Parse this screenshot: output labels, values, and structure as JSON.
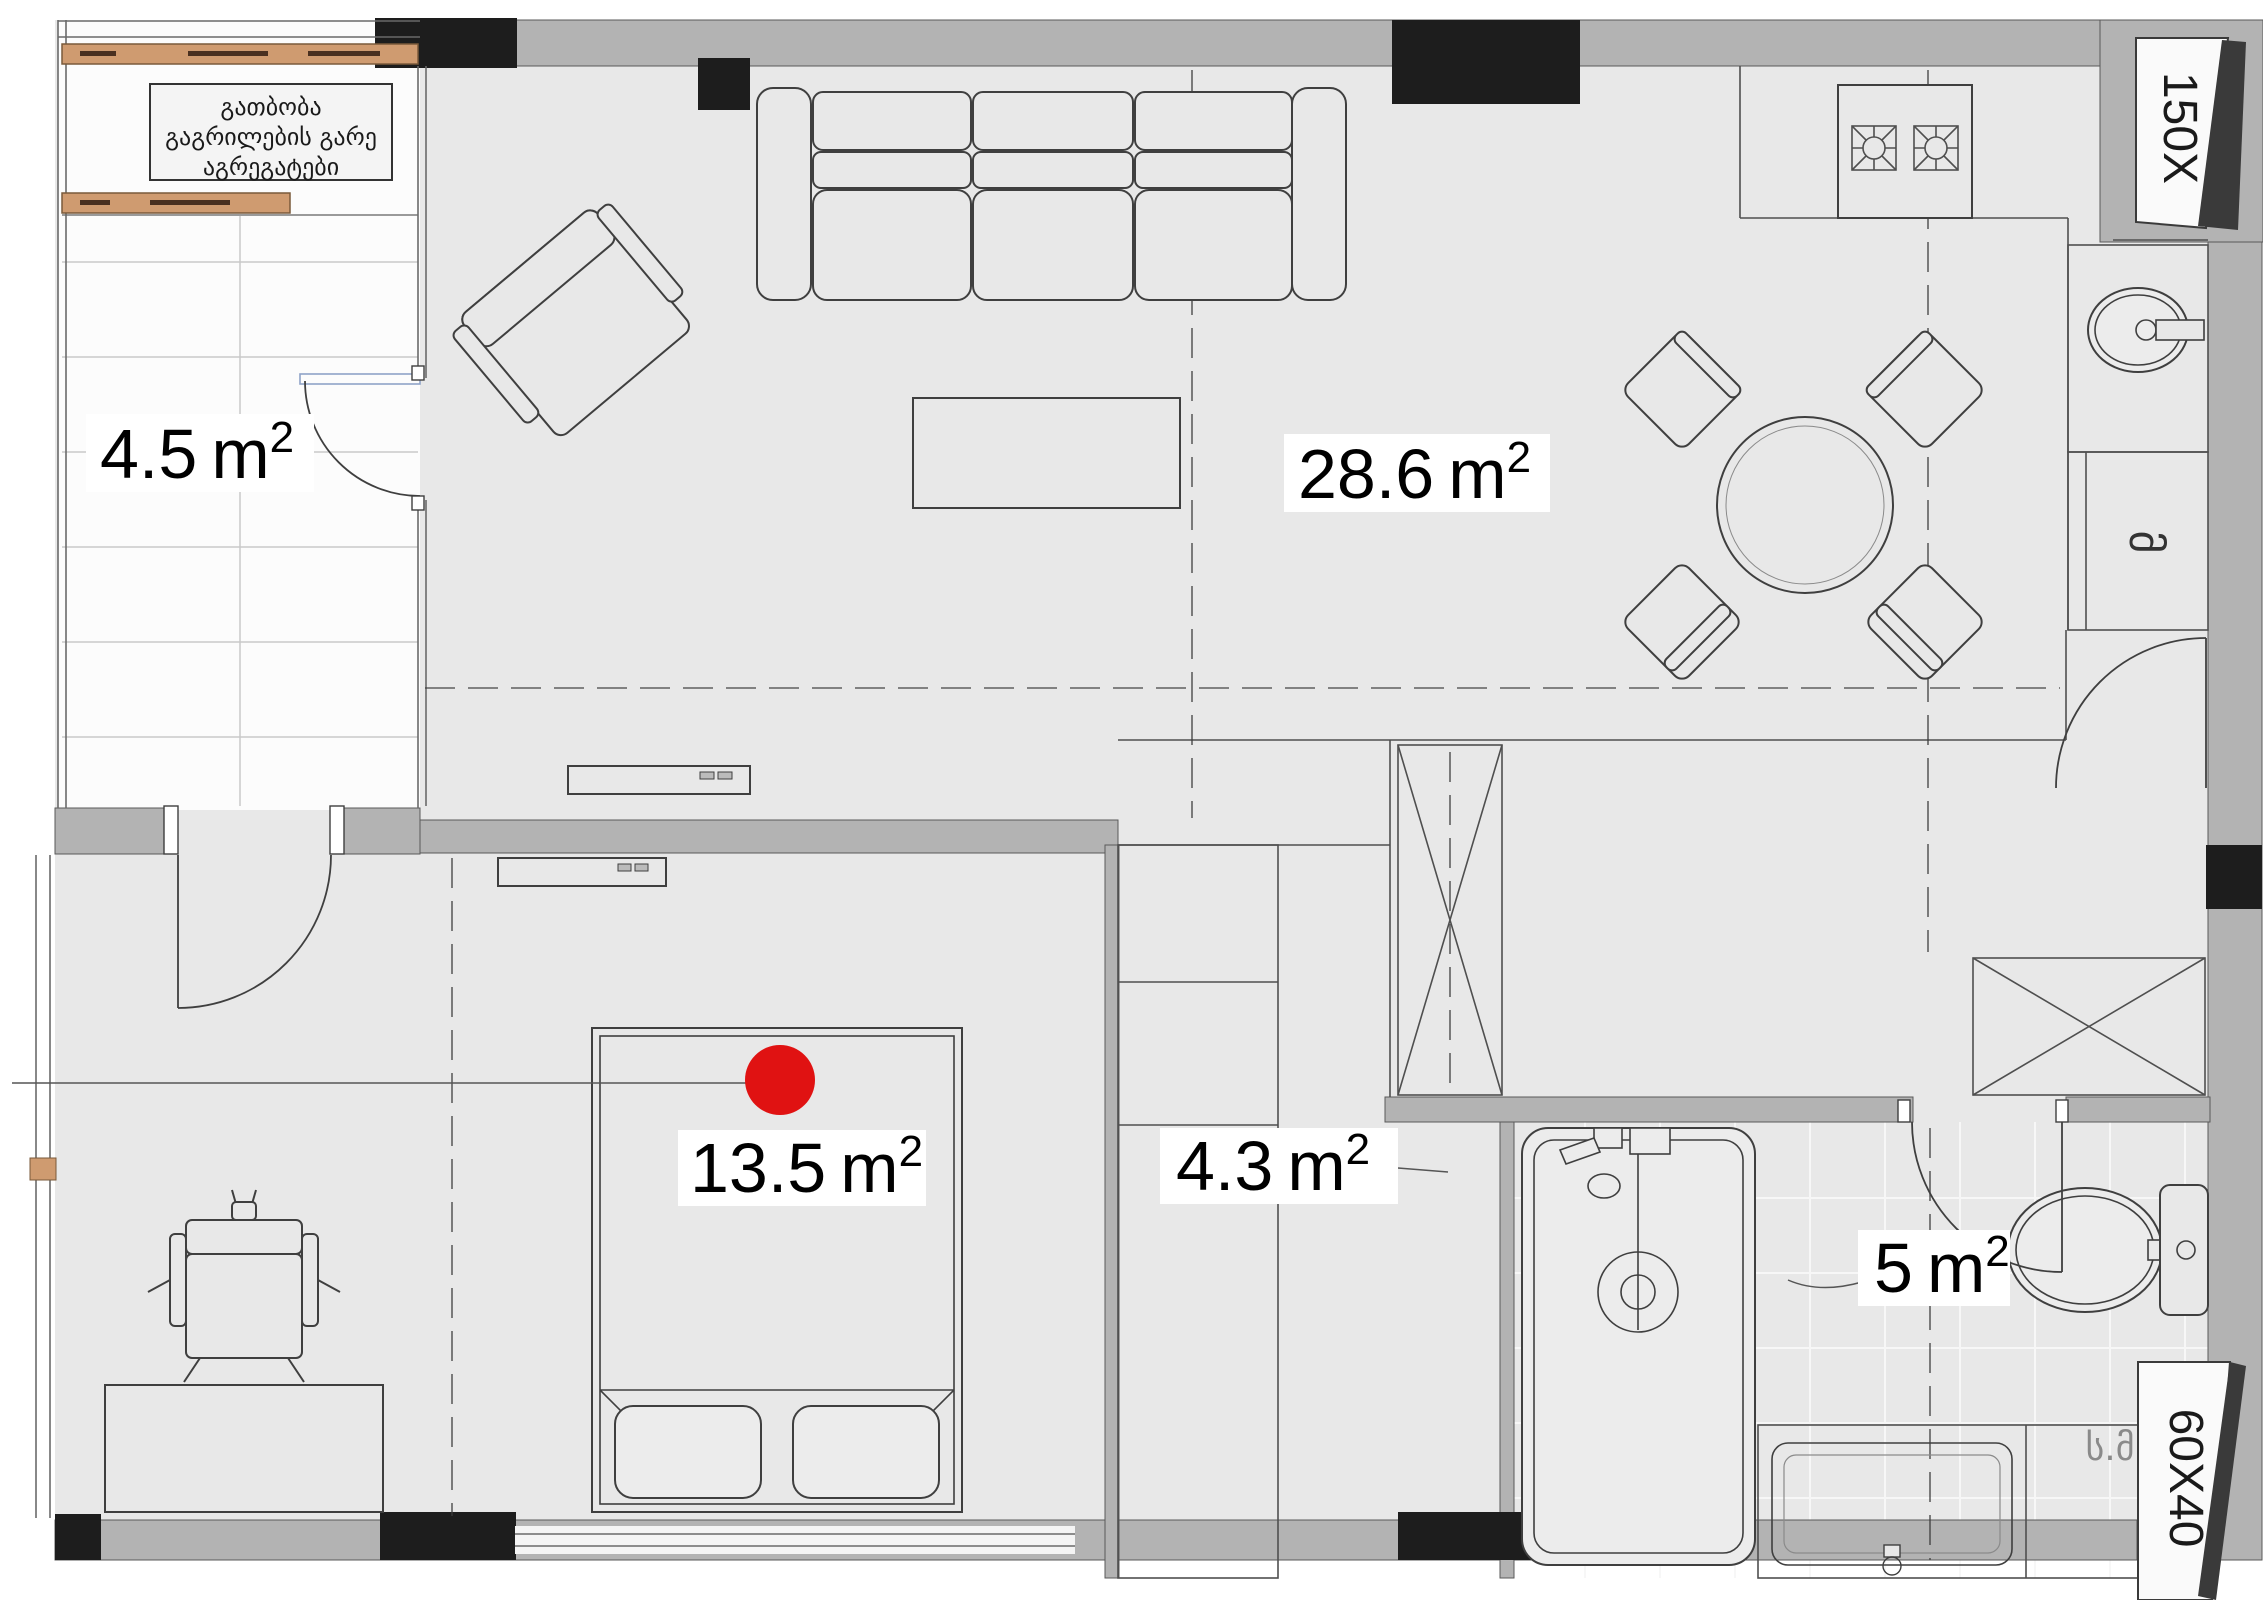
{
  "floor_plan": {
    "note": {
      "line1": "გათბობა",
      "line2": "გაგრილების გარე",
      "line3": "აგრეგატები"
    },
    "rooms": {
      "balcony": {
        "num": "4.5",
        "unit": "m",
        "sup": "2"
      },
      "living": {
        "num": "28.6",
        "unit": "m",
        "sup": "2"
      },
      "bedroom": {
        "num": "13.5",
        "unit": "m",
        "sup": "2"
      },
      "closet": {
        "num": "4.3",
        "unit": "m",
        "sup": "2"
      },
      "bathroom": {
        "num": "5",
        "unit": "m",
        "sup": "2"
      }
    },
    "markers": {
      "shaft_top_right": "150X",
      "shaft_bottom_right": "60X40"
    },
    "texts": {
      "counter_label": "ს.მ",
      "appliance_label": "მ"
    },
    "colors": {
      "marker_red": "#e01212",
      "wall_gray": "#b3b3b3",
      "black_wall": "#1d1d1d",
      "wood_orange": "#cf9b70",
      "floor": "#e8e8e8"
    }
  }
}
